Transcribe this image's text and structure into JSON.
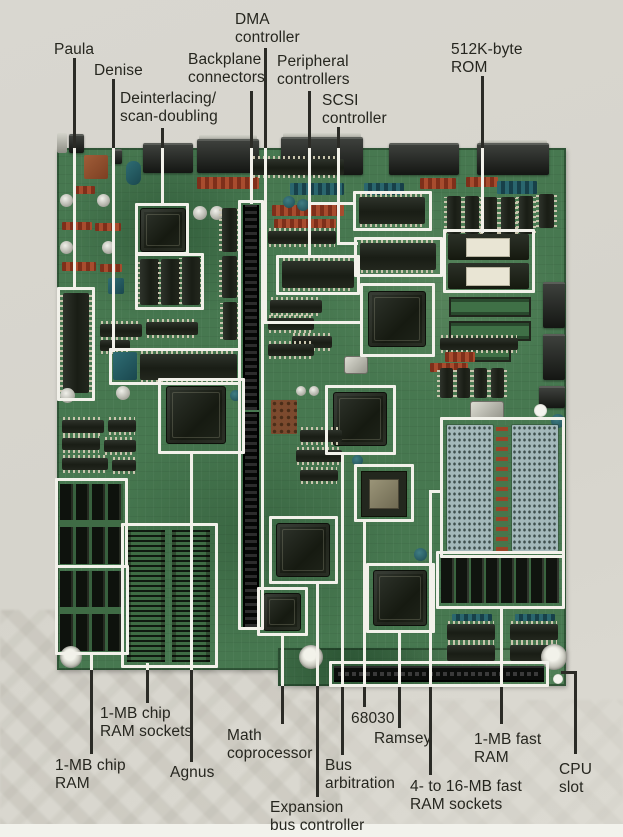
{
  "figure": {
    "type": "annotated-photo",
    "subject": "Computer motherboard with labeled components",
    "colors": {
      "background": "#d8d6cf",
      "board_green": "#477850",
      "outline_white": "#f2f1ea",
      "leader_line_dark": "#2b2b26",
      "label_text": "#26261f"
    },
    "callouts": [
      {
        "id": "paula",
        "lines": [
          "Paula"
        ],
        "tx": 54,
        "ty": 41,
        "segs": [
          {
            "x": 73,
            "y": 58,
            "w": 3,
            "h": 92,
            "c": "d"
          },
          {
            "x": 73,
            "y": 148,
            "w": 3,
            "h": 142,
            "c": "l"
          }
        ],
        "boxes": [
          {
            "x": 57,
            "y": 287,
            "w": 38,
            "h": 114
          }
        ]
      },
      {
        "id": "denise",
        "lines": [
          "Denise"
        ],
        "tx": 94,
        "ty": 62,
        "segs": [
          {
            "x": 112,
            "y": 79,
            "w": 3,
            "h": 71,
            "c": "d"
          },
          {
            "x": 112,
            "y": 148,
            "w": 3,
            "h": 204,
            "c": "l"
          }
        ],
        "boxes": [
          {
            "x": 109,
            "y": 348,
            "w": 132,
            "h": 37
          }
        ]
      },
      {
        "id": "deinterlacing",
        "lines": [
          "Deinterlacing/",
          "scan-doubling"
        ],
        "tx": 120,
        "ty": 90,
        "segs": [
          {
            "x": 161,
            "y": 128,
            "w": 3,
            "h": 22,
            "c": "d"
          },
          {
            "x": 161,
            "y": 148,
            "w": 3,
            "h": 58,
            "c": "l"
          }
        ],
        "boxes": [
          {
            "x": 135,
            "y": 203,
            "w": 54,
            "h": 52
          },
          {
            "x": 135,
            "y": 253,
            "w": 69,
            "h": 57
          }
        ]
      },
      {
        "id": "backplane-connectors",
        "lines": [
          "Backplane",
          "connectors"
        ],
        "tx": 188,
        "ty": 51,
        "segs": [
          {
            "x": 250,
            "y": 91,
            "w": 3,
            "h": 59,
            "c": "d"
          },
          {
            "x": 250,
            "y": 148,
            "w": 3,
            "h": 56,
            "c": "l"
          }
        ],
        "boxes": [
          {
            "x": 238,
            "y": 200,
            "w": 26,
            "h": 430
          }
        ]
      },
      {
        "id": "dma-controller",
        "lines": [
          "DMA",
          "controller"
        ],
        "tx": 235,
        "ty": 11,
        "segs": [
          {
            "x": 264,
            "y": 48,
            "w": 3,
            "h": 102,
            "c": "d"
          },
          {
            "x": 264,
            "y": 148,
            "w": 3,
            "h": 176,
            "c": "l"
          },
          {
            "x": 264,
            "y": 321,
            "w": 99,
            "h": 3,
            "c": "l"
          }
        ],
        "boxes": [
          {
            "x": 360,
            "y": 283,
            "w": 75,
            "h": 74
          }
        ]
      },
      {
        "id": "peripheral-controllers",
        "lines": [
          "Peripheral",
          "controllers"
        ],
        "tx": 277,
        "ty": 53,
        "segs": [
          {
            "x": 308,
            "y": 91,
            "w": 3,
            "h": 59,
            "c": "d"
          },
          {
            "x": 308,
            "y": 148,
            "w": 3,
            "h": 110,
            "c": "l"
          },
          {
            "x": 308,
            "y": 202,
            "w": 48,
            "h": 3,
            "c": "l"
          }
        ],
        "boxes": [
          {
            "x": 353,
            "y": 191,
            "w": 79,
            "h": 40
          },
          {
            "x": 276,
            "y": 255,
            "w": 84,
            "h": 40
          }
        ]
      },
      {
        "id": "scsi-controller",
        "lines": [
          "SCSI",
          "controller"
        ],
        "tx": 322,
        "ty": 92,
        "segs": [
          {
            "x": 337,
            "y": 127,
            "w": 3,
            "h": 23,
            "c": "d"
          },
          {
            "x": 337,
            "y": 148,
            "w": 3,
            "h": 97,
            "c": "l"
          },
          {
            "x": 337,
            "y": 242,
            "w": 21,
            "h": 3,
            "c": "l"
          }
        ],
        "boxes": [
          {
            "x": 354,
            "y": 237,
            "w": 89,
            "h": 40
          }
        ]
      },
      {
        "id": "rom",
        "lines": [
          "512K-byte",
          "ROM"
        ],
        "tx": 451,
        "ty": 41,
        "segs": [
          {
            "x": 481,
            "y": 76,
            "w": 3,
            "h": 74,
            "c": "d"
          },
          {
            "x": 481,
            "y": 148,
            "w": 3,
            "h": 85,
            "c": "l"
          }
        ],
        "boxes": [
          {
            "x": 443,
            "y": 229,
            "w": 92,
            "h": 64
          }
        ]
      },
      {
        "id": "chip-ram-sockets",
        "lines": [
          "1-MB chip",
          "RAM sockets"
        ],
        "tx": 100,
        "ty": 705,
        "segs": [
          {
            "x": 146,
            "y": 663,
            "w": 3,
            "h": 7,
            "c": "l"
          },
          {
            "x": 146,
            "y": 670,
            "w": 3,
            "h": 33,
            "c": "d"
          }
        ],
        "boxes": [
          {
            "x": 121,
            "y": 523,
            "w": 97,
            "h": 145
          }
        ]
      },
      {
        "id": "chip-ram",
        "lines": [
          "1-MB chip",
          "RAM"
        ],
        "tx": 55,
        "ty": 757,
        "segs": [
          {
            "x": 90,
            "y": 652,
            "w": 3,
            "h": 18,
            "c": "l"
          },
          {
            "x": 90,
            "y": 670,
            "w": 3,
            "h": 84,
            "c": "d"
          }
        ],
        "boxes": [
          {
            "x": 55,
            "y": 478,
            "w": 73,
            "h": 90
          },
          {
            "x": 55,
            "y": 565,
            "w": 74,
            "h": 90
          }
        ]
      },
      {
        "id": "agnus",
        "lines": [
          "Agnus"
        ],
        "tx": 170,
        "ty": 764,
        "segs": [
          {
            "x": 190,
            "y": 452,
            "w": 3,
            "h": 218,
            "c": "l"
          },
          {
            "x": 190,
            "y": 670,
            "w": 3,
            "h": 92,
            "c": "d"
          }
        ],
        "boxes": [
          {
            "x": 158,
            "y": 378,
            "w": 87,
            "h": 76
          }
        ]
      },
      {
        "id": "math-coprocessor",
        "lines": [
          "Math",
          "coprocessor"
        ],
        "tx": 227,
        "ty": 727,
        "segs": [
          {
            "x": 281,
            "y": 634,
            "w": 3,
            "h": 52,
            "c": "l"
          },
          {
            "x": 281,
            "y": 686,
            "w": 3,
            "h": 38,
            "c": "d"
          }
        ],
        "boxes": [
          {
            "x": 257,
            "y": 587,
            "w": 51,
            "h": 49
          }
        ]
      },
      {
        "id": "expansion-bus-controller",
        "lines": [
          "Expansion",
          "bus controller"
        ],
        "tx": 270,
        "ty": 799,
        "segs": [
          {
            "x": 316,
            "y": 582,
            "w": 3,
            "h": 104,
            "c": "l"
          },
          {
            "x": 316,
            "y": 686,
            "w": 3,
            "h": 111,
            "c": "d"
          }
        ],
        "boxes": [
          {
            "x": 269,
            "y": 516,
            "w": 69,
            "h": 68
          }
        ]
      },
      {
        "id": "bus-arbitration",
        "lines": [
          "Bus",
          "arbitration"
        ],
        "tx": 325,
        "ty": 757,
        "segs": [
          {
            "x": 341,
            "y": 453,
            "w": 3,
            "h": 233,
            "c": "l"
          },
          {
            "x": 341,
            "y": 686,
            "w": 3,
            "h": 69,
            "c": "d"
          }
        ],
        "boxes": [
          {
            "x": 325,
            "y": 385,
            "w": 71,
            "h": 70
          }
        ]
      },
      {
        "id": "cpu-68030",
        "lines": [
          "68030"
        ],
        "tx": 351,
        "ty": 710,
        "segs": [
          {
            "x": 363,
            "y": 520,
            "w": 3,
            "h": 166,
            "c": "l"
          },
          {
            "x": 363,
            "y": 686,
            "w": 3,
            "h": 21,
            "c": "d"
          }
        ],
        "boxes": [
          {
            "x": 354,
            "y": 464,
            "w": 60,
            "h": 58
          }
        ]
      },
      {
        "id": "ramsey",
        "lines": [
          "Ramsey"
        ],
        "tx": 374,
        "ty": 730,
        "segs": [
          {
            "x": 398,
            "y": 631,
            "w": 3,
            "h": 55,
            "c": "l"
          },
          {
            "x": 398,
            "y": 686,
            "w": 3,
            "h": 42,
            "c": "d"
          }
        ],
        "boxes": [
          {
            "x": 366,
            "y": 563,
            "w": 69,
            "h": 70
          }
        ]
      },
      {
        "id": "fast-ram-sockets",
        "lines": [
          "4- to 16-MB fast",
          "RAM sockets"
        ],
        "tx": 410,
        "ty": 778,
        "segs": [
          {
            "x": 429,
            "y": 490,
            "w": 14,
            "h": 3,
            "c": "l"
          },
          {
            "x": 429,
            "y": 490,
            "w": 3,
            "h": 196,
            "c": "l"
          },
          {
            "x": 429,
            "y": 686,
            "w": 3,
            "h": 89,
            "c": "d"
          }
        ],
        "boxes": [
          {
            "x": 440,
            "y": 417,
            "w": 125,
            "h": 141
          }
        ]
      },
      {
        "id": "fast-ram",
        "lines": [
          "1-MB fast",
          "RAM"
        ],
        "tx": 474,
        "ty": 731,
        "segs": [
          {
            "x": 500,
            "y": 607,
            "w": 3,
            "h": 79,
            "c": "l"
          },
          {
            "x": 500,
            "y": 686,
            "w": 3,
            "h": 38,
            "c": "d"
          }
        ],
        "boxes": [
          {
            "x": 436,
            "y": 551,
            "w": 129,
            "h": 58
          }
        ]
      },
      {
        "id": "cpu-slot",
        "lines": [
          "CPU",
          "slot"
        ],
        "tx": 559,
        "ty": 761,
        "segs": [
          {
            "x": 561,
            "y": 671,
            "w": 16,
            "h": 3,
            "c": "d"
          },
          {
            "x": 574,
            "y": 671,
            "w": 3,
            "h": 83,
            "c": "d"
          }
        ],
        "boxes": [
          {
            "x": 329,
            "y": 661,
            "w": 220,
            "h": 26
          }
        ]
      }
    ]
  }
}
